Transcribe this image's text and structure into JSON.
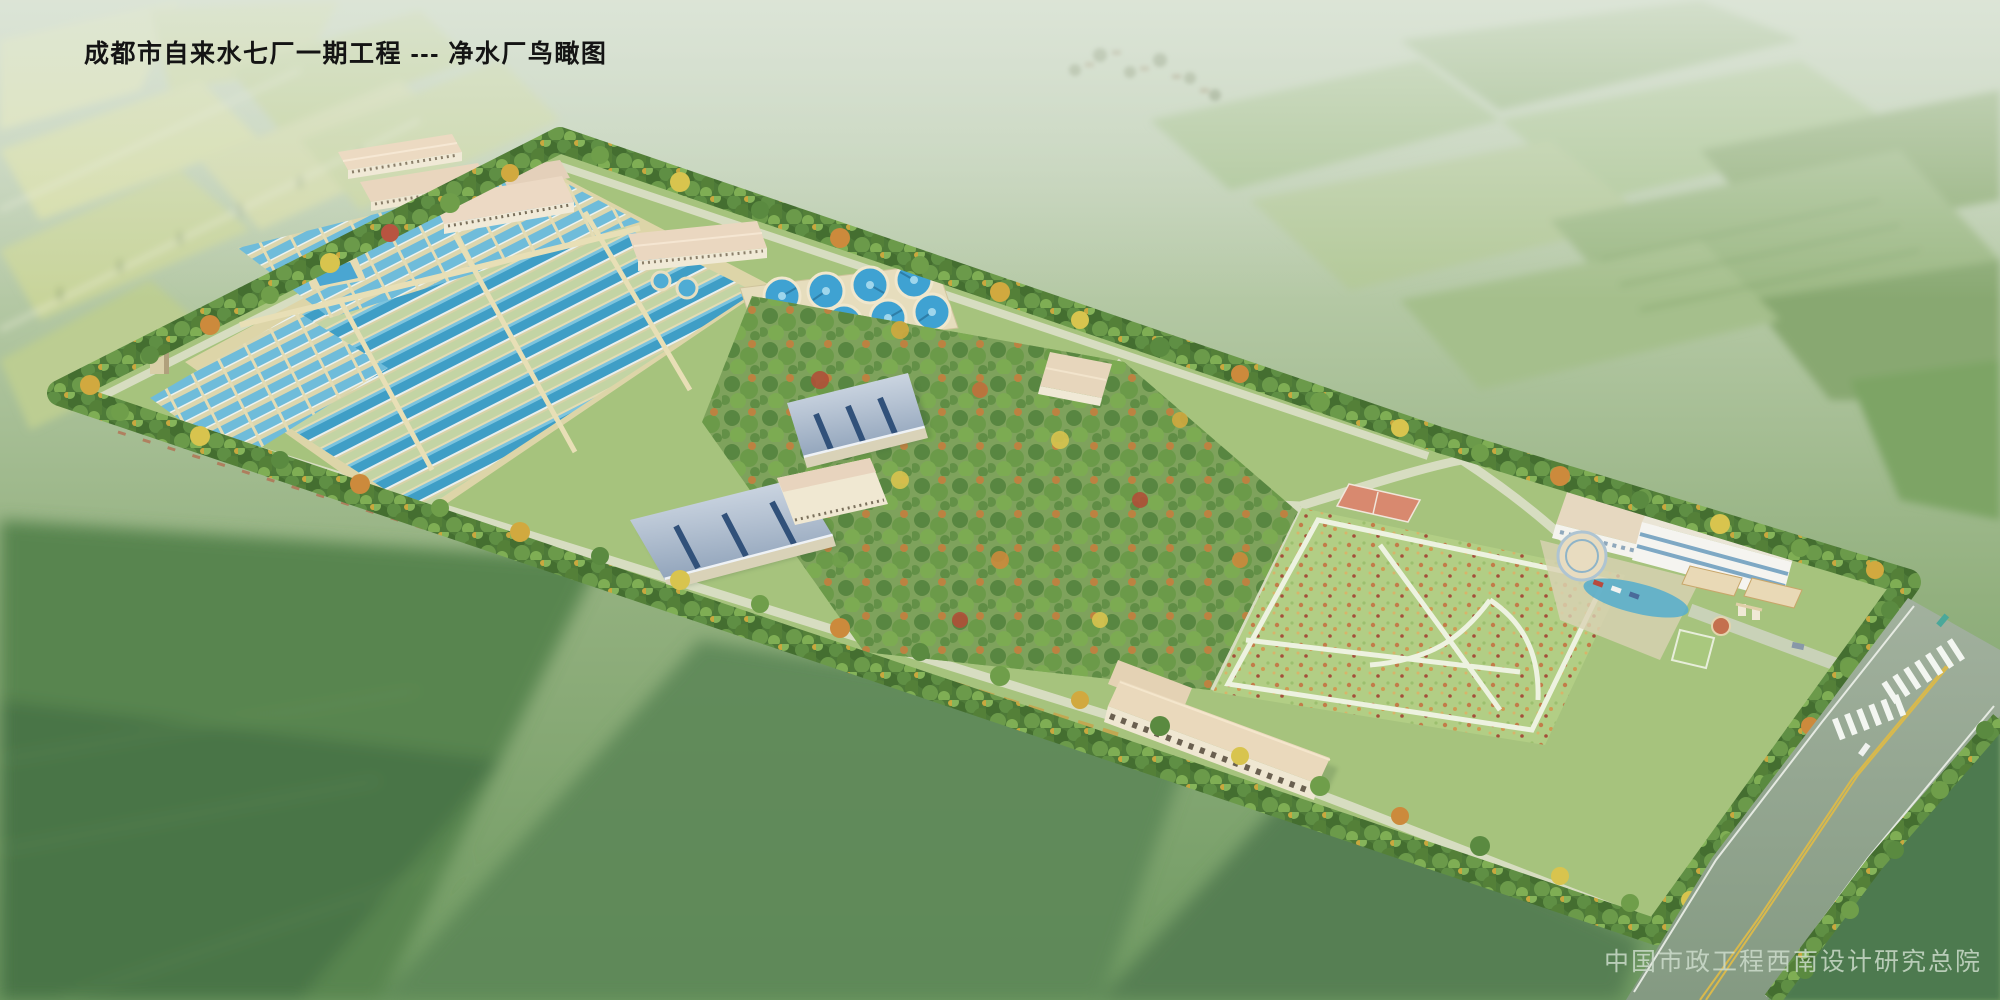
{
  "header": {
    "title": "成都市自来水七厂一期工程 --- 净水厂鸟瞰图"
  },
  "footer": {
    "credit": "中国市政工程西南设计研究总院"
  },
  "scene": {
    "description": "Aerial perspective rendering of a water purification plant campus surrounded by hazy farmland",
    "features": [
      "workshop-buildings",
      "sedimentation-basin-grid",
      "long-filter-lanes",
      "elevated-tank",
      "water-tower",
      "circular-clarifiers",
      "arched-roof-filter-houses",
      "tree-screen-boundary",
      "orchard-nursery",
      "lawn-with-white-paths",
      "basketball-court",
      "administration-complex",
      "round-pavilion",
      "pond",
      "dormitory-building",
      "entrance-gate",
      "main-road",
      "crosswalks",
      "cars",
      "background-fields",
      "village"
    ]
  },
  "palette": {
    "site_green": "#a6c37d",
    "hedge_green": "#4e7a38",
    "pool_water_blue": "#3f9ec6",
    "clarifier_blue": "#3fa2d2",
    "deck_beige": "#e6ddbd",
    "roof_pink": "#ecdac2",
    "arch_roof_silver_blue": "#b6c3d3",
    "arch_roof_slot_blue": "#31517a",
    "road_gray_green": "#93a796",
    "road_center_yellow": "#d9b94c",
    "lawn_green": "#b2ce85",
    "court_red": "#d8896f",
    "title_color": "#141414",
    "credit_color": "#d0dece"
  }
}
